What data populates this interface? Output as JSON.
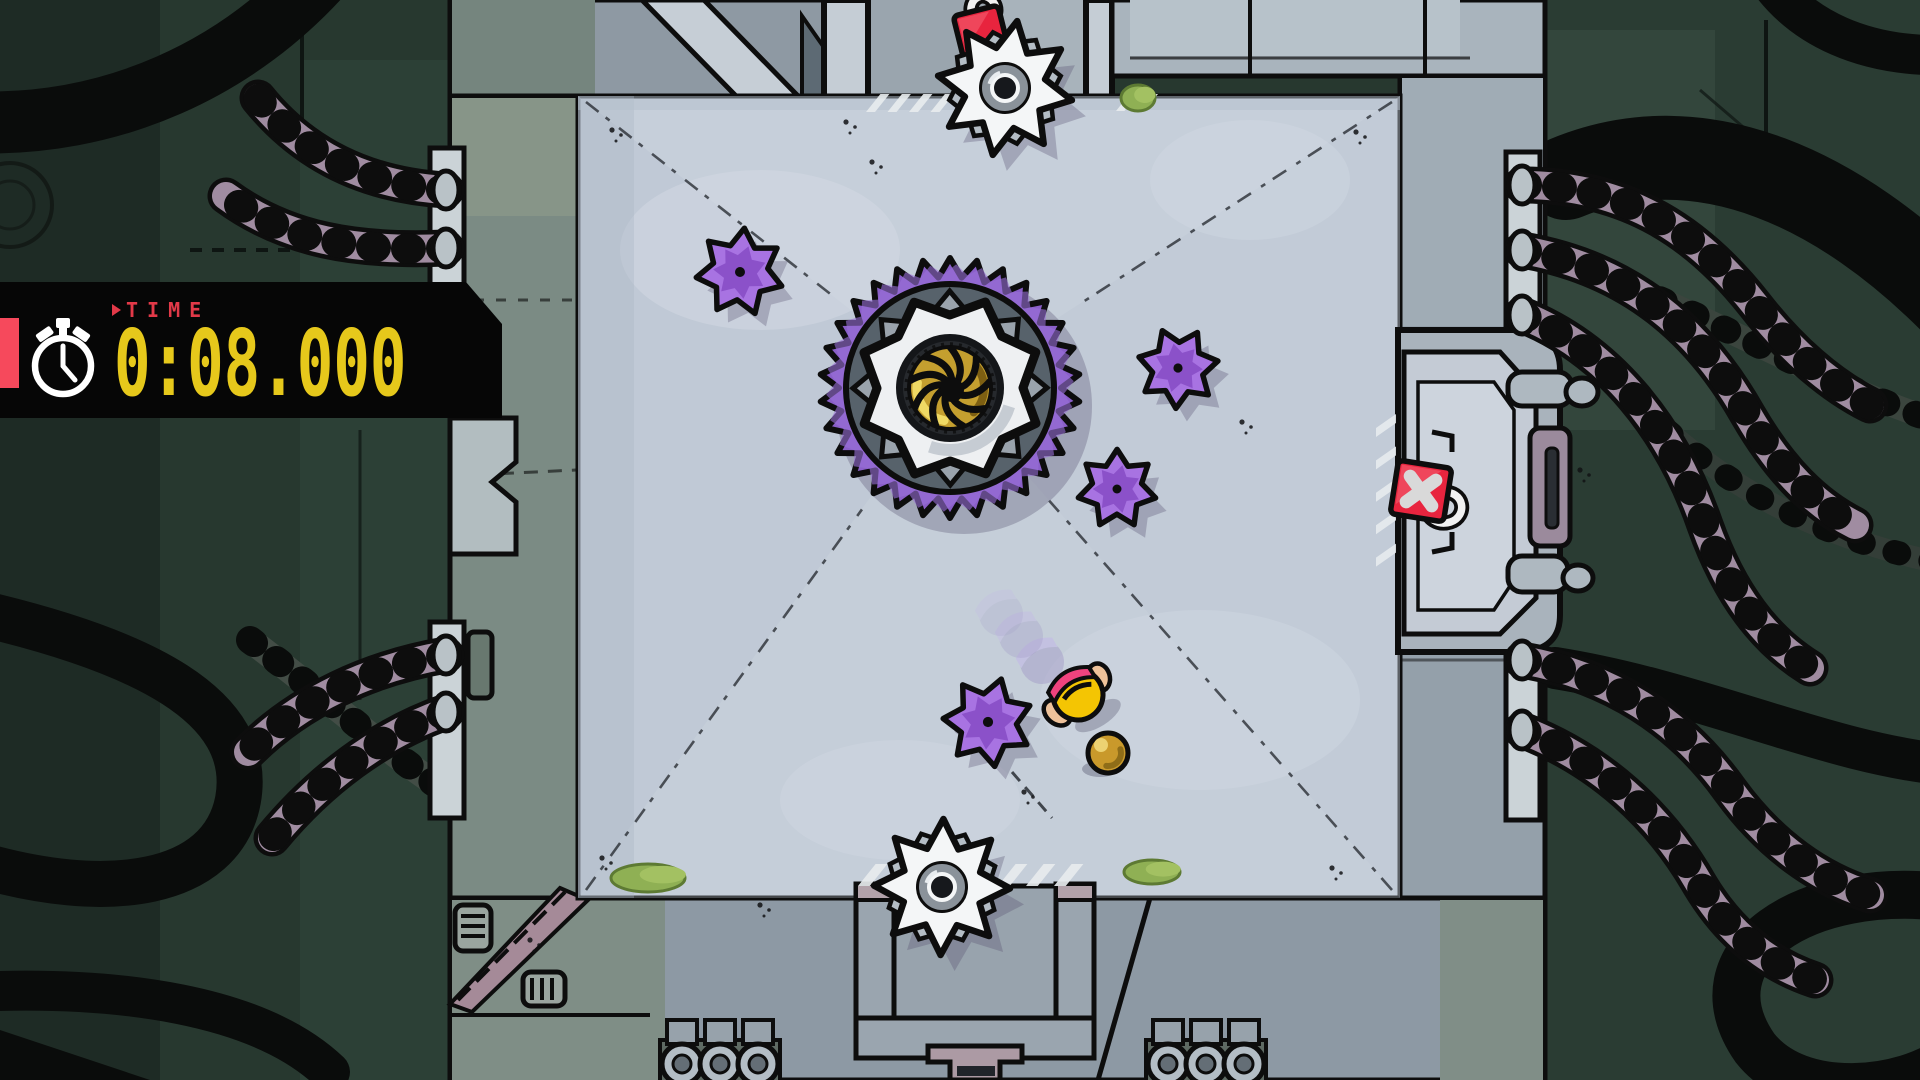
{
  "hud": {
    "time_label": "TIME",
    "time_value": "0:08.000",
    "colors": {
      "panel": "#060606",
      "accent": "#f6495c",
      "label": "#e23948",
      "value": "#e6c81b",
      "icon": "#ffffff"
    }
  },
  "scene": {
    "colors": {
      "floor": "#c6cfda",
      "floor_shade": "#b9c3d1",
      "wall": "#8e99a3",
      "wall_light": "#c5cdd5",
      "wall_green": "#7b8b84",
      "bg": "#27382f",
      "bg_dark": "#1e2b25",
      "ink": "#0d0d0d",
      "cable": "#a08ca1",
      "gear_purple": "#8a5fc8",
      "gear_slate": "#57626b",
      "gear_white": "#eef0f2",
      "gear_gold": "#c49f2f",
      "gold_light": "#efd964",
      "gold_dark": "#7d5f12",
      "disc_purple": "#a873e2",
      "disc_inner": "#8b51c9",
      "saw_white": "#f4f6f7",
      "sign_red": "#e8243e",
      "player_yellow": "#f4c503",
      "player_band": "#f0437e",
      "player_skin": "#eec29a",
      "ghost": "#9d93c4",
      "ghost_band": "#c2b0ec",
      "ball_gold": "#c9992b",
      "ball_light": "#ecd272",
      "ball_dark": "#8f6d18",
      "moss": "#8fb054",
      "moss_dark": "#5d7a33",
      "hazard": "#e7ebee",
      "shadow": "rgba(88,82,112,0.32)"
    },
    "floor": {
      "x": 578,
      "y": 96,
      "w": 822,
      "h": 802
    },
    "gear": {
      "x": 950,
      "y": 388
    },
    "spike_discs": [
      {
        "x": 740,
        "y": 272,
        "s": 1.0,
        "rot": 0.1
      },
      {
        "x": 1178,
        "y": 368,
        "s": 0.92,
        "rot": 0.5
      },
      {
        "x": 1117,
        "y": 489,
        "s": 0.9,
        "rot": 0.9
      },
      {
        "x": 988,
        "y": 722,
        "s": 1.02,
        "rot": 0.3
      }
    ],
    "saw_discs": [
      {
        "x": 1005,
        "y": 88,
        "rot": 0.18
      },
      {
        "x": 942,
        "y": 887,
        "rot": 0.02
      }
    ],
    "signs": [
      {
        "x": 981,
        "y": 33,
        "rot": -14,
        "size": 46,
        "hook": "top",
        "show_x": false
      },
      {
        "x": 1421,
        "y": 491,
        "rot": 9,
        "size": 54,
        "hook": "right",
        "show_x": true
      }
    ],
    "player": {
      "x": 1078,
      "y": 695,
      "rot": -32
    },
    "player_ghosts": [
      {
        "x": 1042,
        "y": 662,
        "o": 0.42
      },
      {
        "x": 1021,
        "y": 636,
        "o": 0.28
      },
      {
        "x": 1001,
        "y": 614,
        "o": 0.18
      }
    ],
    "ball": {
      "x": 1108,
      "y": 753
    },
    "hazard_stripes": [
      {
        "x": 866,
        "y": 94,
        "w": 86,
        "h": 18,
        "n": 4
      },
      {
        "x": 1116,
        "y": 94,
        "w": 40,
        "h": 17,
        "n": 2
      },
      {
        "x": 858,
        "y": 864,
        "w": 224,
        "h": 22,
        "n": 8
      },
      {
        "x": 1376,
        "y": 414,
        "w": 20,
        "h": 162,
        "n": 5,
        "vert": true
      }
    ],
    "moss_patches": [
      {
        "x": 1138,
        "y": 98,
        "w": 34,
        "h": 26
      },
      {
        "x": 648,
        "y": 878,
        "w": 74,
        "h": 28
      },
      {
        "x": 1152,
        "y": 872,
        "w": 56,
        "h": 24
      }
    ],
    "floor_corners": [
      [
        586,
        102
      ],
      [
        1392,
        102
      ],
      [
        586,
        890
      ],
      [
        1392,
        890
      ]
    ],
    "extra_scratches": [
      [
        1012,
        772,
        1052,
        818
      ]
    ],
    "speckles": [
      [
        612,
        130
      ],
      [
        846,
        122
      ],
      [
        1356,
        132
      ],
      [
        602,
        858
      ],
      [
        1332,
        868
      ],
      [
        1242,
        422
      ],
      [
        1024,
        792
      ],
      [
        872,
        162
      ],
      [
        1408,
        350
      ],
      [
        1500,
        640
      ],
      [
        470,
        300
      ],
      [
        530,
        940
      ],
      [
        1580,
        470
      ],
      [
        760,
        905
      ]
    ]
  }
}
